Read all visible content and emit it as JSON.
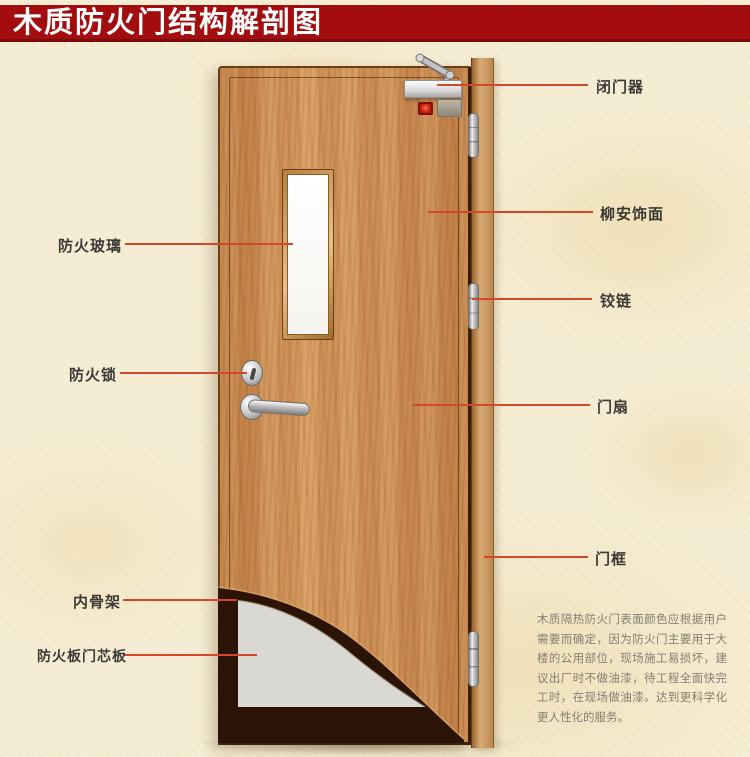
{
  "title": "木质防火门结构解剖图",
  "callouts": {
    "left": [
      {
        "label": "防火玻璃"
      },
      {
        "label": "防火锁"
      },
      {
        "label": "内骨架"
      },
      {
        "label": "防火板门芯板"
      }
    ],
    "right": [
      {
        "label": "闭门器"
      },
      {
        "label": "柳安饰面"
      },
      {
        "label": "铰链"
      },
      {
        "label": "门扇"
      },
      {
        "label": "门框"
      }
    ]
  },
  "description": "木质隔热防火门表面颜色应根据用户需要而确定，因为防火门主要用于大楼的公用部位，现场施工易损坏，建议出厂时不做油漆，待工程全面快完工时，在现场做油漆。达到更科学化更人性化的服务。",
  "colors": {
    "banner": "#a40d10",
    "banner_text": "#ffffff",
    "background": "#f5eed6",
    "callout_line": "#d64729",
    "label_text": "#3c3a36",
    "door_wood": "#d0935a",
    "frame_wood": "#d2a269",
    "core_board": "#d9d8d2",
    "inner_skeleton": "#2b1406",
    "glass": "#ffffff"
  }
}
